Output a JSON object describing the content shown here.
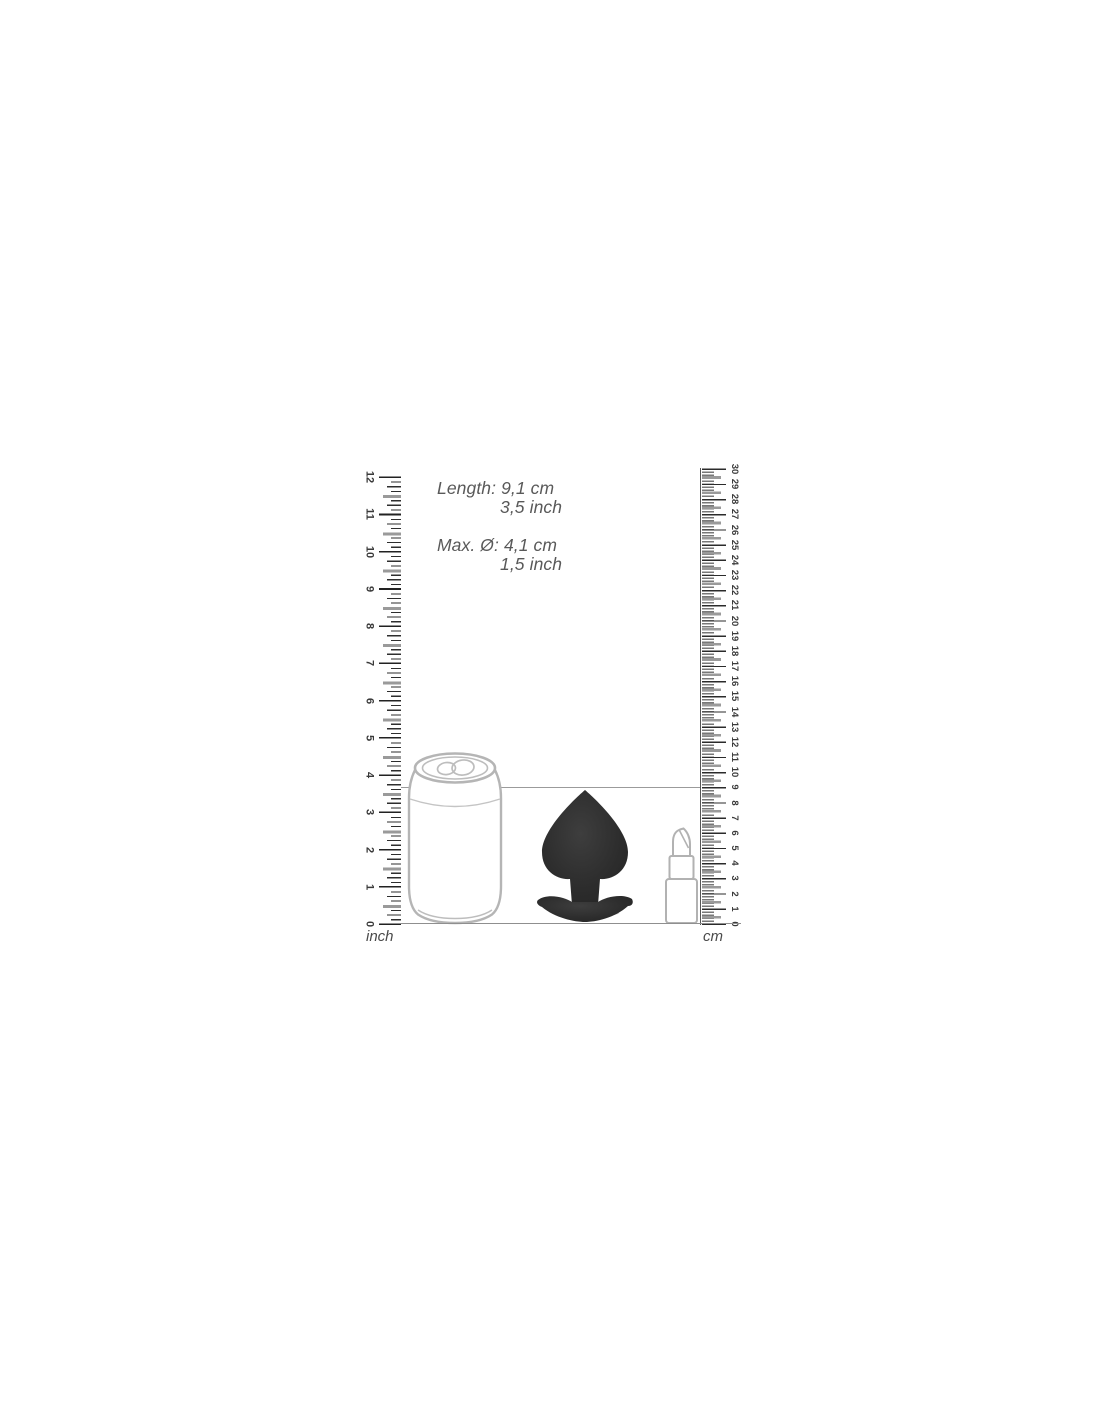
{
  "measurements": [
    {
      "label": "Length:",
      "metric": "9,1 cm",
      "imperial": "3,5 inch"
    },
    {
      "label": "Max. Ø:",
      "metric": "4,1 cm",
      "imperial": "1,5 inch"
    }
  ],
  "rulers": {
    "left": {
      "unit": "inch",
      "min": 0,
      "max": 12
    },
    "right": {
      "unit": "cm",
      "min": 0,
      "max": 30
    }
  },
  "objects": [
    {
      "name": "soda-can"
    },
    {
      "name": "butt-plug"
    },
    {
      "name": "lipstick"
    }
  ],
  "colors": {
    "plug_fill": "#2e2e2e",
    "outline_gray": "#b5b5b5",
    "text_gray": "#595959",
    "tick_dark": "#2e2e2e",
    "tick_half_gray": "#9a9a9a",
    "reference_line": "#9b9b9b"
  }
}
